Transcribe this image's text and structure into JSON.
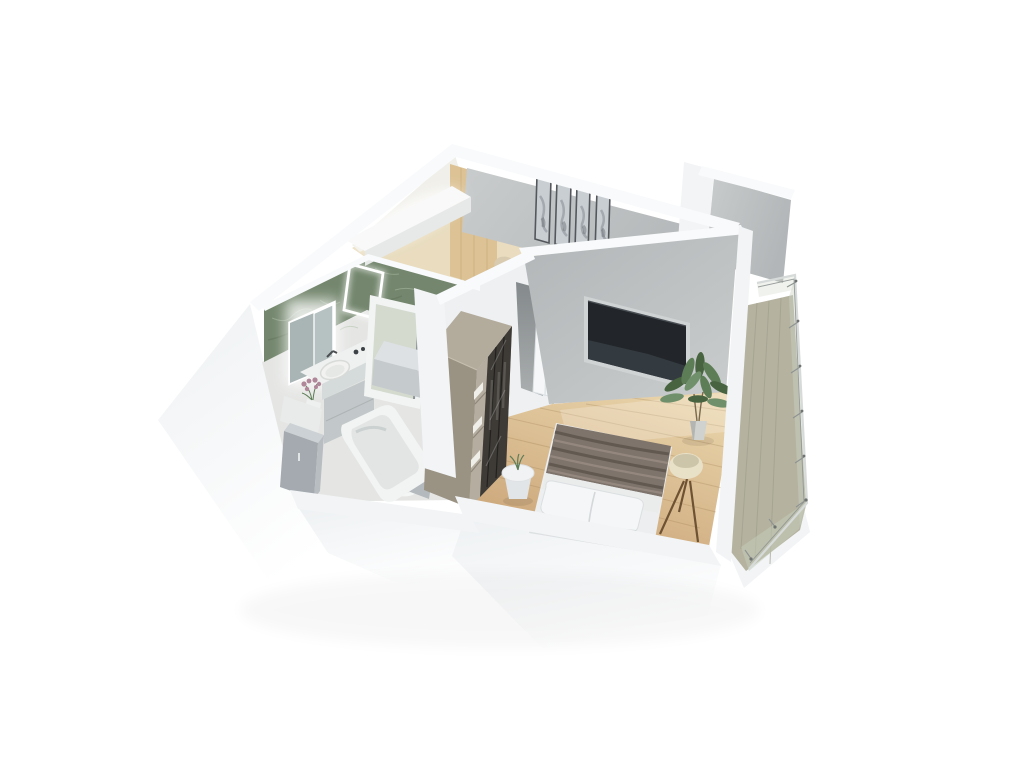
{
  "scene": {
    "type": "isometric-3d-apartment-floorplan-render",
    "background": "#ffffff",
    "rooms": {
      "bathroom": {
        "wall_finish": "green-marble",
        "objects": [
          "led-mirror",
          "led-frame",
          "vanity-counter",
          "vessel-sink",
          "faucet",
          "flower-vase",
          "side-table",
          "tall-cabinet",
          "shower-door",
          "toilet",
          "bathtub"
        ]
      },
      "hallway": {
        "objects": [
          "kitchen-counter",
          "wood-wall-panel",
          "appliance-box",
          "chairs"
        ]
      },
      "bedroom": {
        "objects": [
          "wall-art-panels",
          "tv",
          "door",
          "wardrobe",
          "double-bed",
          "pillow",
          "blanket",
          "side-table",
          "tripod-floor-lamp",
          "potted-plant"
        ]
      },
      "balcony": {
        "objects": [
          "plank-floor",
          "glass-railing",
          "railing-posts"
        ]
      }
    },
    "art_panel_count": 4,
    "wardrobe_glass_door_count": 3
  },
  "palette": {
    "bg": "#ffffff",
    "wallTop": "#f8fafb",
    "wallBand": "#f2f4f6",
    "slab": "#eef1f3",
    "wallGrayDark": "#b2b6b8",
    "wallGrayLight": "#c9cccc",
    "wallWhite": "#eef0f2",
    "greenWall": "#74876e",
    "greenDark": "#5d7257",
    "greenLight": "#aebfa6",
    "woodPanel": "#dcc295",
    "woodGrain": "#c4a678",
    "floorKitchen": "#e9dcbf",
    "floorHall": "#dcc49c",
    "floorWoodLight": "#ead5ab",
    "floorWoodDark": "#c79f73",
    "plankLine": "#9c7a50",
    "floorBath": "#e5e6e4",
    "balconyFloor": "#b5b3a0",
    "balconyPlank": "#a09e8b",
    "glassTint": "#ccd3c4",
    "glassTint2": "#c6cdb9",
    "railSteel": "#8e9392",
    "railLight": "#d6dad9",
    "wardrobeTop": "#b3ab9c",
    "wardrobeLeft": "#9a9283",
    "wardrobeFront": "#a79f90",
    "wardrobeShelf": "#b5aea0",
    "shelfWhite": "#f0eee8",
    "wardrobeGlass": "#3e3b37",
    "glassFrame": "#23211e",
    "doorWhite": "#f5f7f8",
    "doorLine": "#e0e4e6",
    "doorwayDark": "#84898b",
    "tvNiche": "#d0d3d4",
    "tvDark": "#22262a",
    "tvReflect": "#394148",
    "artFrame": "#54585d",
    "artBg": "#c9ced3",
    "artInk": "#8f959b",
    "artInkDark": "#6e747a",
    "bedWhite": "#eceeef",
    "bedBottom": "#dde0e2",
    "pillow": "#f4f6f7",
    "blanket": "#7e746c",
    "blanketDark": "#5f564f",
    "blanketLight": "#968a81",
    "duvet": "#eaecec",
    "tableTop": "#f0f2f3",
    "tableSide": "#e2e5e7",
    "lampShade": "#e8e0c7",
    "lampInner": "#cdc5a9",
    "lampLeg": "#6d5233",
    "plantGreen": "#47633f",
    "plantMid": "#5d7d57",
    "plantLight": "#70906b",
    "pot": "#cfd2cf",
    "potShade": "#b2b5b2",
    "counterWhite": "#f8f9f8",
    "counterFront": "#e6e9e8",
    "boxTop": "#dde1e4",
    "boxFront": "#c5cacd",
    "chair": "#d8cbaf",
    "chairDark": "#c2b294",
    "vanityTop": "#eff1f0",
    "vanityFront": "#d5dada",
    "vanityBody": "#c2c8c9",
    "cabinetFront": "#a4aaaf",
    "cabinetTop": "#ccd1d5",
    "cabinetSide": "#b8bdc2",
    "sink": "#f2f3f1",
    "tubPanel": "#b4b9bd",
    "tubRim": "#f2f4f4",
    "tubInner": "#e2e5e4",
    "fixtureWhite": "#f4f5f5",
    "flower": "#b08798",
    "mirrorGlass": "#b6c1c1",
    "mirrorDark": "#a9b4b5",
    "led": "#ffffff",
    "metalDark": "#4a4f52"
  }
}
